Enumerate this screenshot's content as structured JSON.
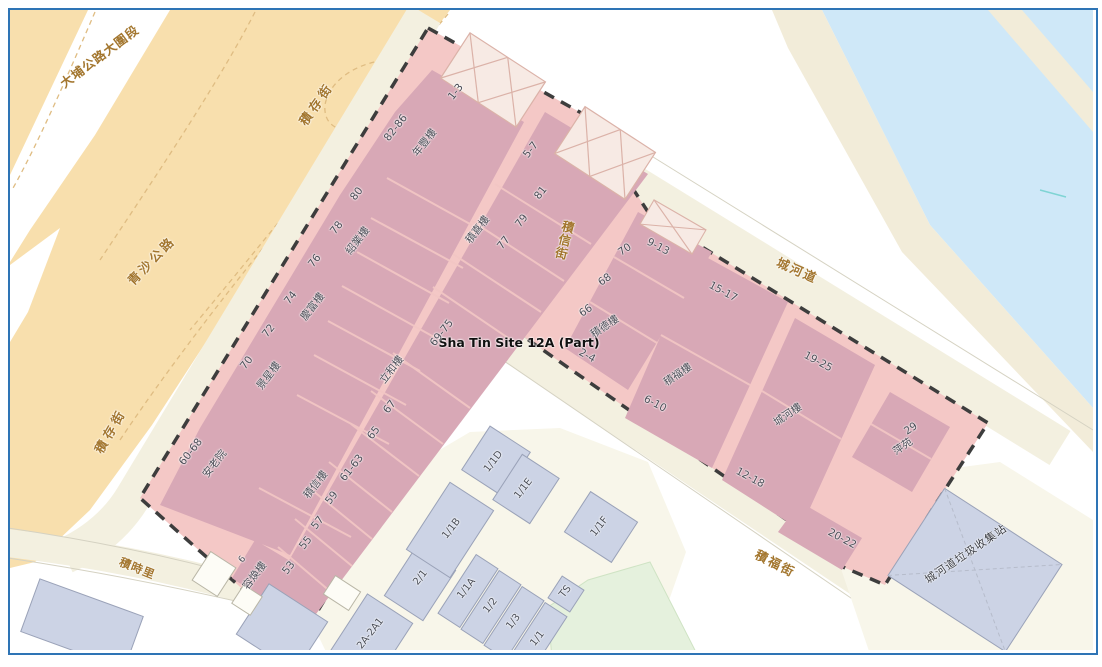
{
  "site": {
    "label": "Sha Tin Site 12A (Part)"
  },
  "streets": {
    "tai_po_road": "大埔公路大圍段",
    "tsing_sha_highway": "青沙公路",
    "chik_chuen_street_upper": "積存街",
    "chik_chuen_street_lower": "積存街",
    "chik_shun_street": "積信街",
    "shing_ho_road": "城河道",
    "chik_fuk_street": "積福街",
    "chik_shi_lane": "積時里"
  },
  "facility": {
    "refuse_station": "城河道垃圾收集站"
  },
  "west_row": {
    "n1": "82-86",
    "name1": "年豐樓",
    "n2": "80",
    "n3": "78",
    "name3": "紹業樓",
    "n4": "76",
    "n5": "74",
    "name5": "慶富樓",
    "n6": "72",
    "n7": "70",
    "name7": "景星樓",
    "n8": "60-68",
    "name8": "安老院",
    "n9": "6",
    "name9": "容煥樓"
  },
  "east_row": {
    "n1": "1-3",
    "n2": "5-7",
    "n3": "81",
    "n4": "79",
    "n5": "77",
    "name5": "積喜樓",
    "n6": "69-75",
    "name6": "立和樓",
    "n7": "67",
    "n8": "65",
    "n9": "61-63",
    "n10": "59",
    "name10": "積信樓",
    "n11": "57",
    "n12": "55",
    "n13": "53"
  },
  "right_wing": {
    "n_913": "9-13",
    "n_1517": "15-17",
    "n_1925": "19-25",
    "n_24": "2-4",
    "n_610": "6-10",
    "n_1218": "12-18",
    "n_2022": "20-22",
    "n_70": "70",
    "n_68": "68",
    "n_66": "66",
    "chik_tak_house": "積德樓",
    "chik_fuk_house": "積福樓",
    "shing_ho_house": "城河樓",
    "n_29": "29",
    "ping_yuen": "萍苑"
  },
  "lots": {
    "a": "2/1",
    "b": "1/1A",
    "c": "1/2",
    "d": "1/3",
    "e": "1/1",
    "f": "TS",
    "g": "1/1B",
    "h": "1/1D",
    "i": "1/1E",
    "j": "1/1F",
    "k": "2A-2A1"
  },
  "colors": {
    "frame_border": "#2e74b5",
    "site_fill": "#f4c8c6",
    "building_fill": "#d8a8b6",
    "water": "#cfe8f8",
    "highway": "#f8dfad",
    "road_cream": "#f3f0e0",
    "street_label": "#a3762e",
    "grey_building": "#ccd3e5",
    "boundary_dash": "#3d3d3d"
  }
}
